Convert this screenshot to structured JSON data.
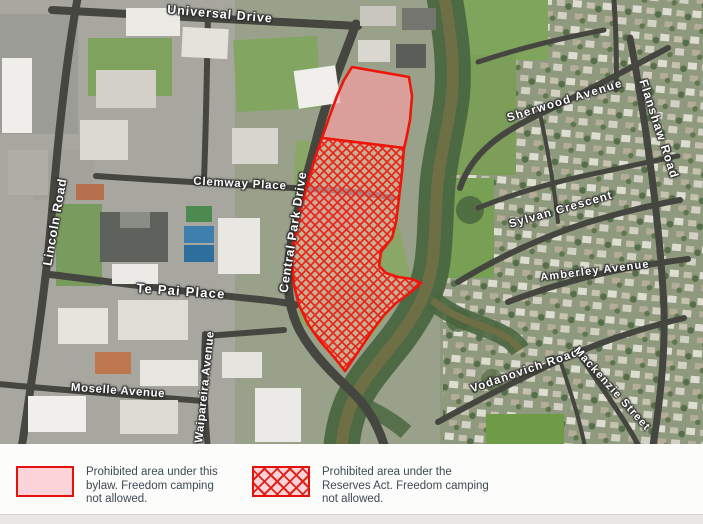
{
  "map": {
    "areas": [
      {
        "id": "bylaw-prohibited-area",
        "style": "solid-pink"
      },
      {
        "id": "reserves-act-prohibited-area",
        "style": "red-crosshatch"
      }
    ],
    "road_labels": [
      {
        "name": "universal-drive",
        "text": "Universal Drive",
        "x": 220,
        "y": 14,
        "rotate": 5,
        "size": 12.5,
        "spacing": 1
      },
      {
        "name": "lincoln-road",
        "text": "Lincoln Road",
        "x": 55,
        "y": 222,
        "rotate": -80,
        "size": 12.5,
        "spacing": 0.8
      },
      {
        "name": "clemway-place",
        "text": "Clemway Place",
        "x": 240,
        "y": 184,
        "rotate": 3,
        "size": 11.5,
        "spacing": 0.8
      },
      {
        "name": "central-park-drive",
        "text": "Central Park Drive",
        "x": 293,
        "y": 232,
        "rotate": -81,
        "size": 12.5,
        "spacing": 0.8
      },
      {
        "name": "te-pai-place",
        "text": "Te Pai Place",
        "x": 181,
        "y": 291,
        "rotate": 4,
        "size": 13,
        "spacing": 1.2
      },
      {
        "name": "moselle-avenue",
        "text": "Moselle Avenue",
        "x": 118,
        "y": 391,
        "rotate": 4,
        "size": 11.5,
        "spacing": 0.6
      },
      {
        "name": "waipareira-avenue",
        "text": "Waipareira Avenue",
        "x": 205,
        "y": 387,
        "rotate": -84,
        "size": 11.5,
        "spacing": 0.6
      },
      {
        "name": "sherwood-avenue",
        "text": "Sherwood Avenue",
        "x": 565,
        "y": 101,
        "rotate": -17,
        "size": 11.5,
        "spacing": 1.4
      },
      {
        "name": "flanshaw-road",
        "text": "Flanshaw Road",
        "x": 659,
        "y": 129,
        "rotate": 72,
        "size": 12,
        "spacing": 1.2
      },
      {
        "name": "sylvan-crescent",
        "text": "Sylvan Crescent",
        "x": 561,
        "y": 210,
        "rotate": -16,
        "size": 11.5,
        "spacing": 1.2
      },
      {
        "name": "amberley-avenue",
        "text": "Amberley Avenue",
        "x": 595,
        "y": 271,
        "rotate": -7,
        "size": 11,
        "spacing": 1.2
      },
      {
        "name": "vodanovich-road",
        "text": "Vodanovich Road",
        "x": 525,
        "y": 371,
        "rotate": -19,
        "size": 11.5,
        "spacing": 1.2
      },
      {
        "name": "mackenzie-street",
        "text": "Mackenzie Street",
        "x": 612,
        "y": 389,
        "rotate": 48,
        "size": 11,
        "spacing": 1.2
      }
    ]
  },
  "legend": {
    "items": [
      {
        "id": "bylaw",
        "swatch": "solid-pink",
        "label": "Prohibited area under this bylaw. Freedom camping not allowed."
      },
      {
        "id": "reserves-act",
        "swatch": "red-crosshatch",
        "label": "Prohibited area under the Reserves Act. Freedom camping not allowed."
      }
    ]
  },
  "colors": {
    "prohibited_border": "#ee1509",
    "prohibited_fill_pink": "#f6a6aa",
    "hatch_line": "#e8261a",
    "legend_swatch_fill": "#fbd3d8",
    "legend_text": "#3e4a54"
  }
}
